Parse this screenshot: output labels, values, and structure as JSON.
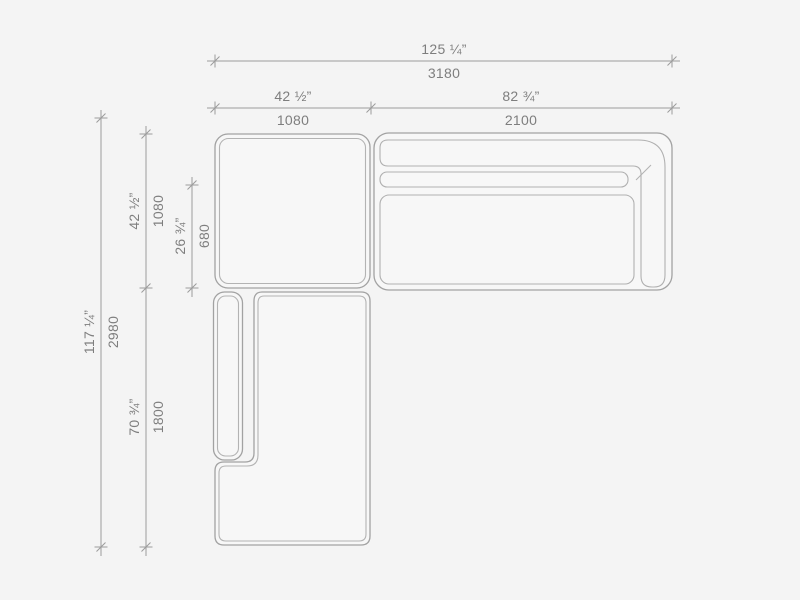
{
  "page": {
    "background_color": "#f4f4f4"
  },
  "drawing": {
    "subject": "sectional-sofa-plan-view",
    "units": [
      "inches",
      "mm"
    ],
    "colors": {
      "background": "#f4f4f4",
      "furniture_fill": "#f7f7f7",
      "outline": "#a2a2a2",
      "inner_outline": "#b3b3b3",
      "dimension_line": "#9c9c9c",
      "label_text": "#7e7e7e"
    },
    "dimensions": {
      "total_width": {
        "inches": "125 ¼”",
        "mm": "3180"
      },
      "top_left_module_width": {
        "inches": "42 ½”",
        "mm": "1080"
      },
      "top_right_module_width": {
        "inches": "82 ¾”",
        "mm": "2100"
      },
      "total_depth": {
        "inches": "117 ¼”",
        "mm": "2980"
      },
      "top_module_depth": {
        "inches": "42 ½”",
        "mm": "1080"
      },
      "seat_depth": {
        "inches": "26 ¾”",
        "mm": "680"
      },
      "left_module_length": {
        "inches": "70 ¾”",
        "mm": "1800"
      }
    }
  }
}
